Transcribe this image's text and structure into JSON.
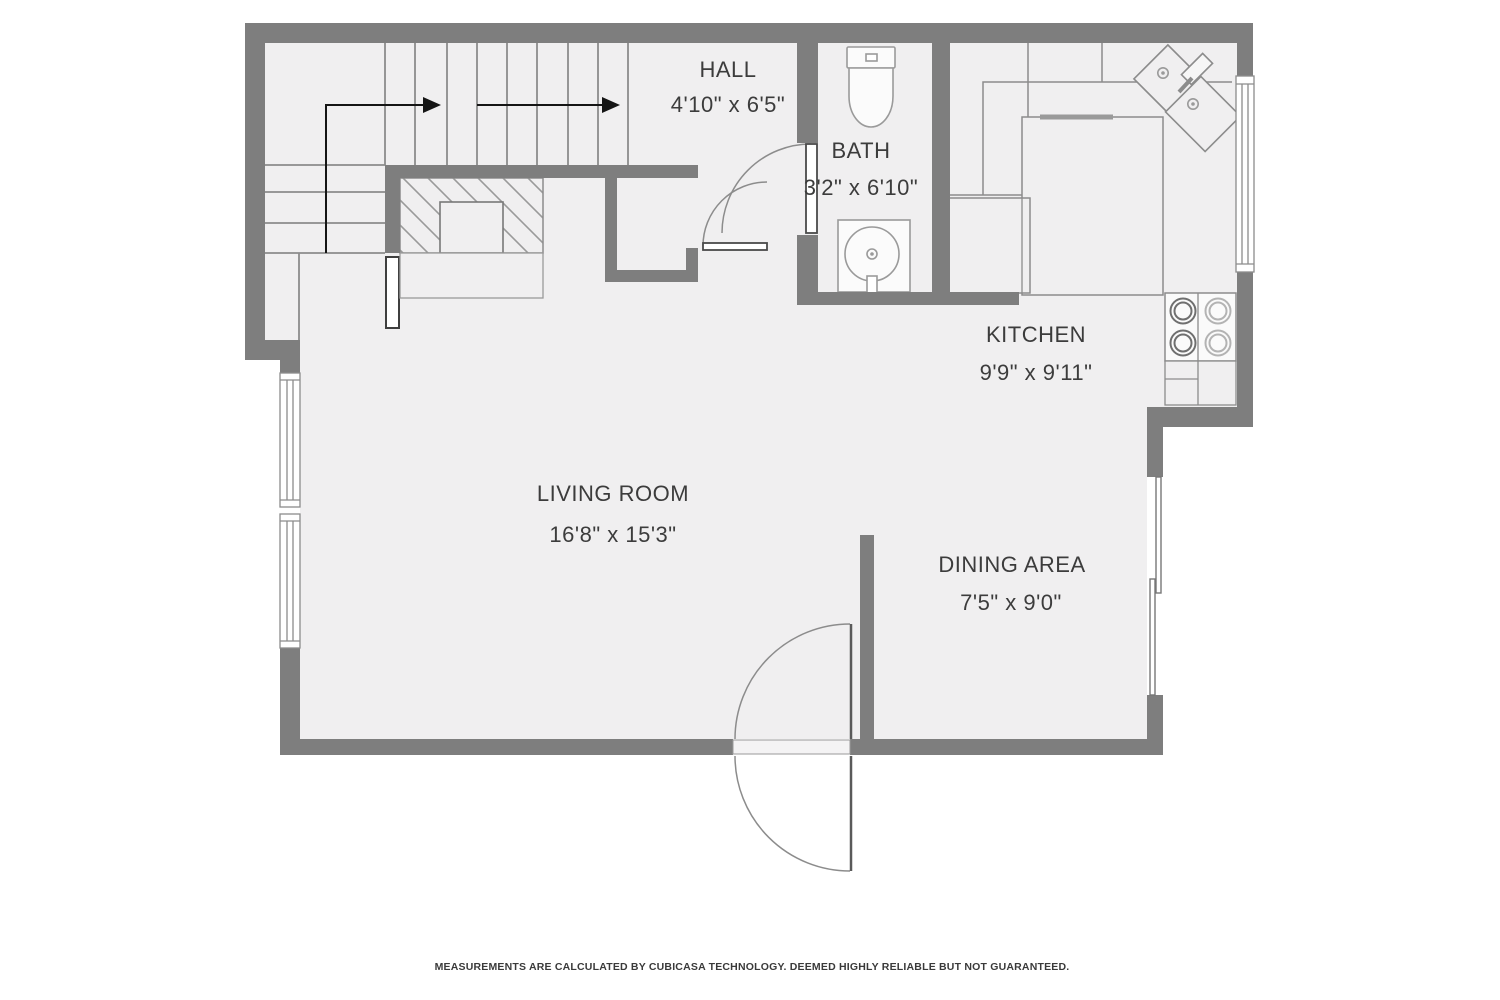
{
  "document": {
    "type": "residential-floor-plan",
    "provider": "CubiCasa"
  },
  "rooms": [
    {
      "id": "hall",
      "name": "HALL",
      "dimensions": "4'10\" x 6'5\""
    },
    {
      "id": "bath",
      "name": "BATH",
      "dimensions": "3'2\" x 6'10\""
    },
    {
      "id": "kitchen",
      "name": "KITCHEN",
      "dimensions": "9'9\" x 9'11\""
    },
    {
      "id": "living_room",
      "name": "LIVING ROOM",
      "dimensions": "16'8\" x 15'3\""
    },
    {
      "id": "dining_area",
      "name": "DINING AREA",
      "dimensions": "7'5\" x 9'0\""
    }
  ],
  "fixtures": [
    "staircase",
    "stair-direction-arrow",
    "under-stair-storage",
    "hall-closet",
    "toilet",
    "bathroom-sink",
    "kitchen-corner-double-sink",
    "stove-4-burner",
    "refrigerator",
    "kitchen-counters",
    "left-wall-windows",
    "kitchen-window",
    "dining-sliding-door",
    "entry-double-swing-door",
    "bath-door",
    "closet-door"
  ],
  "colors": {
    "wall": "#7e7e7e",
    "floor": "#f0eff0",
    "line": "#8c8c8c",
    "text": "#3c3c3c",
    "background": "#ffffff"
  },
  "footer": {
    "disclaimer": "MEASUREMENTS ARE CALCULATED BY CUBICASA TECHNOLOGY. DEEMED HIGHLY RELIABLE BUT NOT GUARANTEED."
  }
}
